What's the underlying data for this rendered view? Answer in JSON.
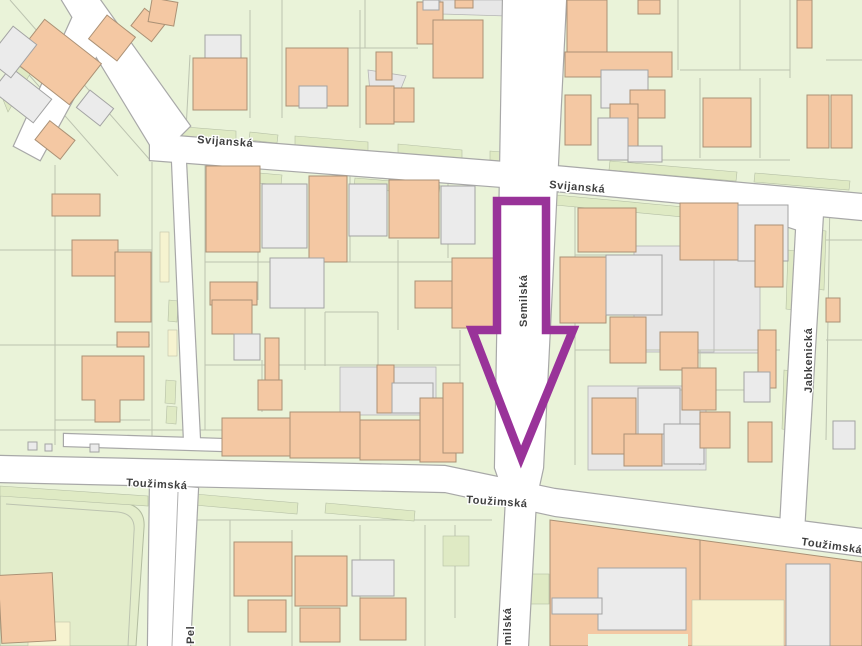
{
  "map": {
    "street_labels": [
      {
        "id": "svijanska-left",
        "text": "Svijanská"
      },
      {
        "id": "svijanska-right",
        "text": "Svijanská"
      },
      {
        "id": "semilska-center",
        "text": "Semilská"
      },
      {
        "id": "semilska-bottom",
        "text": "Semilská"
      },
      {
        "id": "touzimska-left",
        "text": "Toužimská"
      },
      {
        "id": "touzimska-mid",
        "text": "Toužimská"
      },
      {
        "id": "touzimska-right",
        "text": "Toužimská"
      },
      {
        "id": "jabkenicka",
        "text": "Jabkenická"
      },
      {
        "id": "pel-partial",
        "text": "Pel"
      }
    ],
    "colors": {
      "parcel_green": "#EAF3D9",
      "verge_green": "#DFEAC4",
      "park_green": "#E3EDCB",
      "building_salmon": "#F4C8A3",
      "building_gray": "#EBEBEB",
      "parcel_yellow": "#F6F3D0",
      "road_white": "#FFFFFF",
      "outline_gray": "#A8A8A8",
      "label_color": "#3F3F3F",
      "arrow_purple": "#993399"
    },
    "annotation": {
      "type": "down-arrow",
      "description": "hollow purple arrow pointing down along Semilská toward the Toužimská intersection",
      "color": "#993399"
    }
  }
}
